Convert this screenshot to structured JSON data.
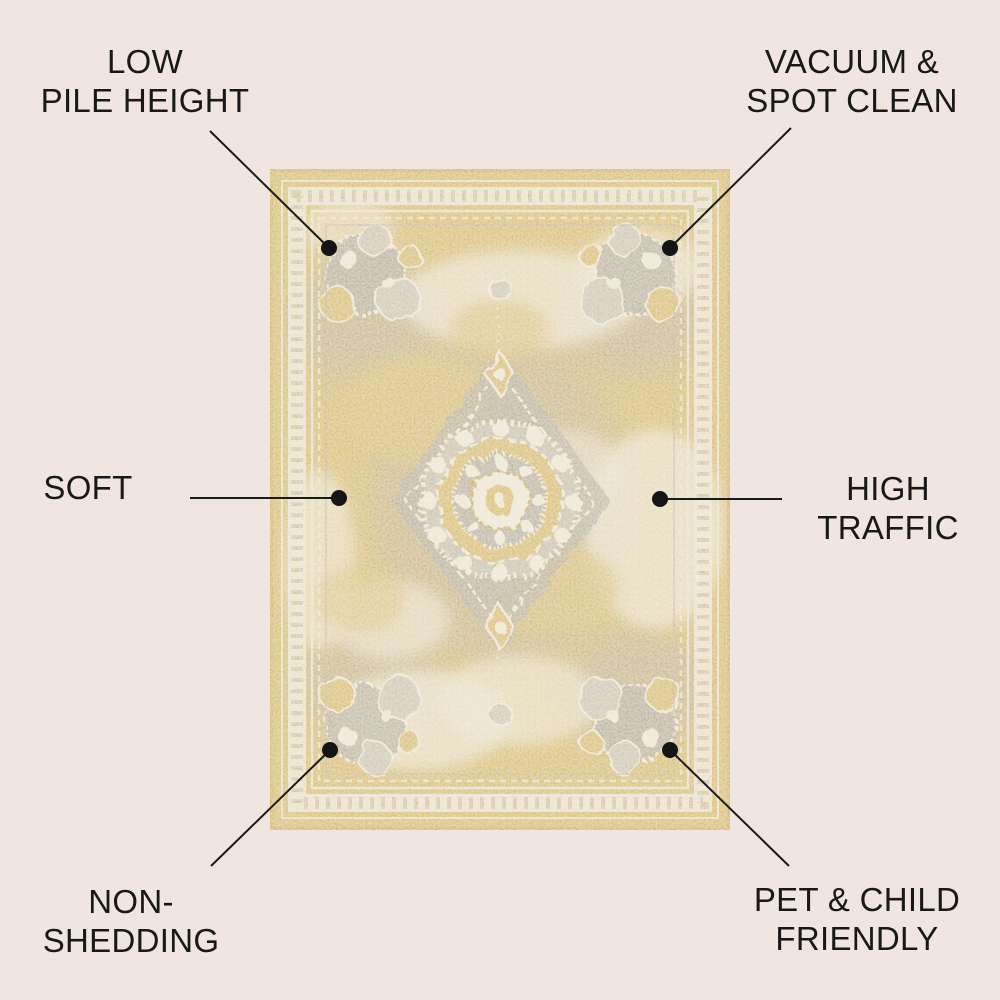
{
  "page": {
    "background_color": "#f0e5e0",
    "description": "Feature infographic of a distressed gold medallion area rug"
  },
  "rug": {
    "alt": "distressed vintage medallion rug in gold, ivory and grey",
    "colors": {
      "gold": "#d7bb6f",
      "gold_dark": "#cdb063",
      "gold_light": "#e6d193",
      "ivory": "#ece4d0",
      "grey": "#b4ad9f",
      "grey_light": "#cdc5b3"
    }
  },
  "connector": {
    "color": "#1a1a1a",
    "line_width": 2,
    "dot_radius": 8
  },
  "callouts": [
    {
      "id": "low-pile-height",
      "line1": "LOW",
      "line2": "PILE HEIGHT",
      "dot": {
        "x": 329,
        "y": 248
      },
      "line": {
        "x1": 210,
        "y1": 131,
        "x2": 329,
        "y2": 248
      }
    },
    {
      "id": "vacuum-spot-clean",
      "line1": "VACUUM &",
      "line2": "SPOT CLEAN",
      "dot": {
        "x": 670,
        "y": 248
      },
      "line": {
        "x1": 791,
        "y1": 128,
        "x2": 670,
        "y2": 248
      }
    },
    {
      "id": "soft",
      "line1": "SOFT",
      "line2": "",
      "dot": {
        "x": 339,
        "y": 498
      },
      "line": {
        "x1": 190,
        "y1": 498,
        "x2": 339,
        "y2": 498
      }
    },
    {
      "id": "high-traffic",
      "line1": "HIGH",
      "line2": "TRAFFIC",
      "dot": {
        "x": 660,
        "y": 499
      },
      "line": {
        "x1": 782,
        "y1": 499,
        "x2": 660,
        "y2": 499
      }
    },
    {
      "id": "non-shedding",
      "line1": "NON-",
      "line2": "SHEDDING",
      "dot": {
        "x": 330,
        "y": 750
      },
      "line": {
        "x1": 211,
        "y1": 866,
        "x2": 330,
        "y2": 750
      }
    },
    {
      "id": "pet-child-friendly",
      "line1": "PET & CHILD",
      "line2": "FRIENDLY",
      "dot": {
        "x": 670,
        "y": 750
      },
      "line": {
        "x1": 789,
        "y1": 866,
        "x2": 670,
        "y2": 750
      }
    }
  ]
}
